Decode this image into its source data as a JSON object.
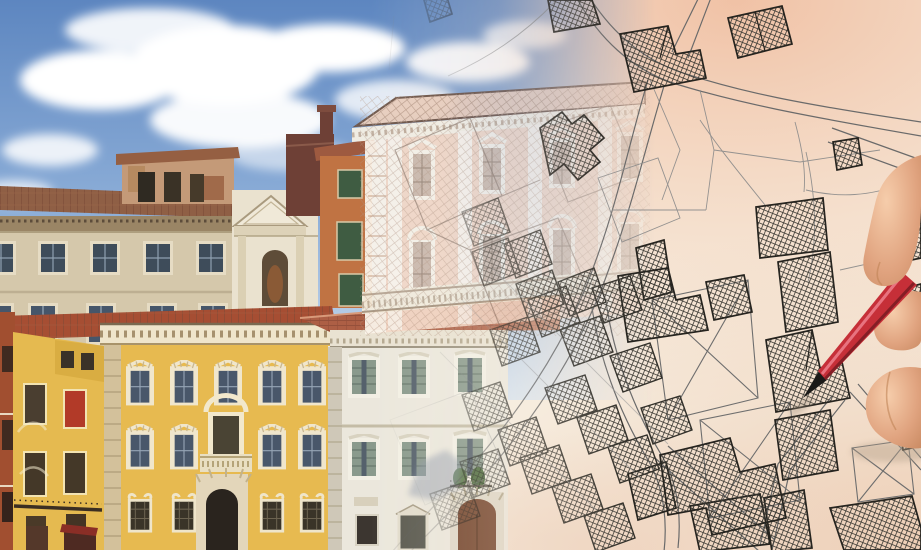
{
  "scene": {
    "description": "Photo-composite: historic Italian palazzo facades under a blue sky on the left, dissolving into a hand-drawn cadastral parcel map on cream paper on the right, with a hand holding a red pencil pointing at a cross-hatched parcel",
    "left_photograph": {
      "elements": [
        "blue-sky",
        "cumulus-clouds",
        "beige-palazzo",
        "rooftop-altana",
        "white-church-facade",
        "brick-tower",
        "orange-house-green-shutters",
        "terracotta-roofs",
        "rust-building",
        "small-yellow-house",
        "grand-yellow-palazzo",
        "white-grey-palazzo",
        "arched-portals",
        "window-with-red-curtain"
      ]
    },
    "transition": {
      "elements": [
        "pink-palazzo-becoming-line-drawing",
        "overlaid-survey-grid",
        "ghost-parcel-outlines"
      ]
    },
    "cadastral_map": {
      "elements": [
        "roads",
        "parcel-boundaries",
        "cross-hatched-buildings",
        "x-diagonal-parcels",
        "dense-diagonal-block-cluster"
      ]
    },
    "hand_and_pencil": {
      "elements": [
        "index-finger",
        "thumb",
        "resting-finger",
        "red-pencil",
        "black-pencil-tip",
        "paper-shadows"
      ],
      "pencil_pointing_at": "cross-hatched parcel near map center-right"
    }
  },
  "colors": {
    "sky_top": "#5d86c0",
    "sky_mid": "#8fb0d9",
    "sky_bottom": "#cfdfEF",
    "cloud_white": "#ffffff",
    "paper_base": "#f8f2e6",
    "paper_peach": "#f0bfa2",
    "paper_peach_deep": "#eccab0",
    "map_road_line": "#6a6a6a",
    "parcel_line": "#8a8a8a",
    "building_stroke": "#26241f",
    "hatch_line": "#3c3a34",
    "beige_facade": "#d5c8ab",
    "beige_roof": "#8f5f45",
    "frieze": "#9a8565",
    "altana_face": "#c49a78",
    "church_face": "#eae2cf",
    "brick_tower": "#6e4036",
    "orange_facade": "#c07343",
    "green_shutter": "#3f5c42",
    "rust_building": "#a14f30",
    "red_roof": "#a64e33",
    "yellow_small": "#e5ba50",
    "yellow_palazzo": "#e7ba50",
    "window_dark": "#46566a",
    "curtain_red": "#b23a28",
    "terracotta": "#ad5f45",
    "white_palazzo": "#ebe7dc",
    "stone_trim": "#d3c19b",
    "door_brown": "#74462e",
    "portal_dark": "#2a241e",
    "pink_facade": "#f3d9c8",
    "pink_trim": "#f6f0e4",
    "pencil_red": "#c62f38",
    "pencil_highlight": "#ee7f8c",
    "pencil_dark": "#7d1d24",
    "pencil_tip": "#1b1a18",
    "skin_light": "#f6cdab",
    "skin_mid": "#e0a37f",
    "skin_shadow": "#c98a62",
    "paper_shadow": "#b5a28c"
  }
}
